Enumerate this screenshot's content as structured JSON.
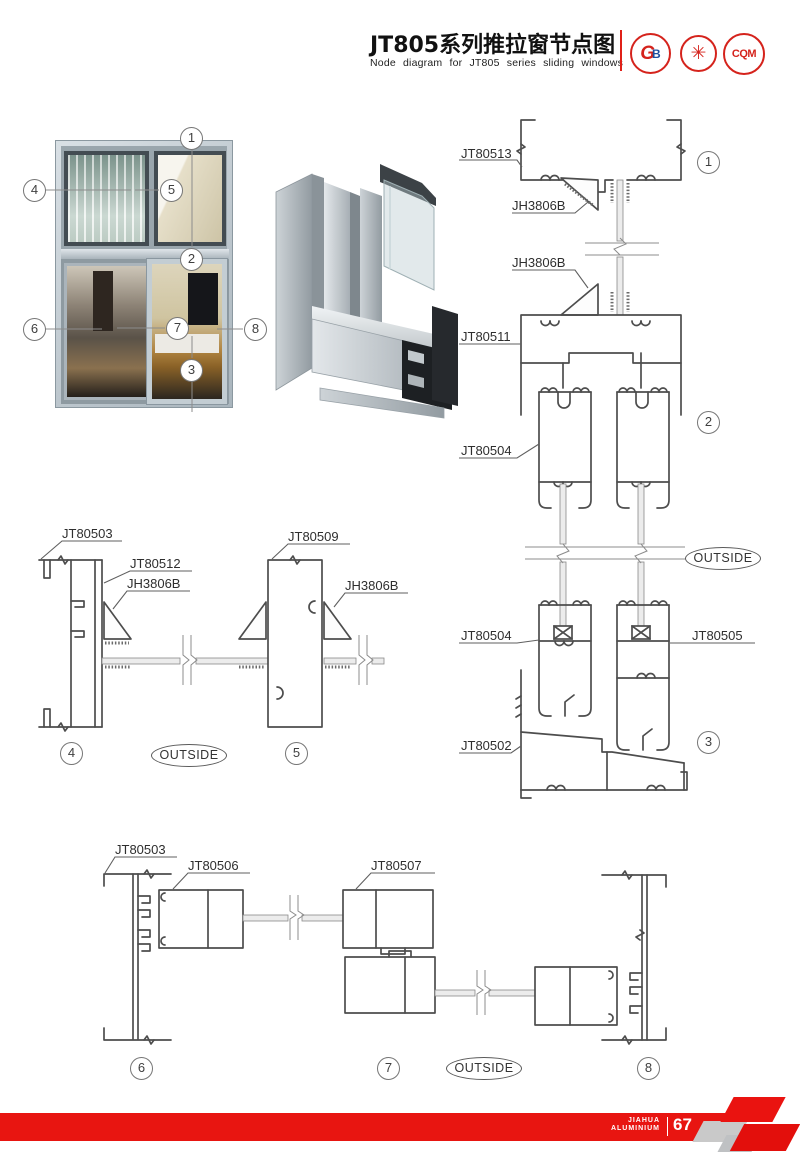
{
  "header": {
    "title_cn": "JT805系列推拉窗节点图",
    "title_en": "Node diagram for JT805 series sliding windows",
    "logos": [
      {
        "name": "gb-cert-badge",
        "letter_g": "G",
        "letter_b": "B"
      },
      {
        "name": "quality-seal-badge",
        "text": "✳"
      },
      {
        "name": "cqm-cert-badge",
        "text": "CQM"
      }
    ]
  },
  "colors": {
    "accent_red": "#e81511",
    "drawing_line": "#4d4d4d"
  },
  "overview": {
    "callouts": [
      "1",
      "2",
      "3",
      "4",
      "5",
      "6",
      "7",
      "8"
    ]
  },
  "right_column": {
    "labels": {
      "jt80513": "JT80513",
      "jh3806b_top": "JH3806B",
      "jh3806b_bottom": "JH3806B",
      "jt80511": "JT80511",
      "jt80504_mid": "JT80504",
      "jt80504_low": "JT80504",
      "jt80505": "JT80505",
      "jt80502": "JT80502"
    },
    "callout_1": "1",
    "callout_2": "2",
    "callout_3": "3",
    "outside": "OUTSIDE"
  },
  "mid_left": {
    "labels": {
      "jt80503": "JT80503",
      "jt80512": "JT80512",
      "jh3806b_left": "JH3806B",
      "jt80509": "JT80509",
      "jh3806b_right": "JH3806B"
    },
    "callout_4": "4",
    "callout_5": "5",
    "outside": "OUTSIDE"
  },
  "bottom_row": {
    "labels": {
      "jt80503": "JT80503",
      "jt80506": "JT80506",
      "jt80507": "JT80507"
    },
    "callout_6": "6",
    "callout_7": "7",
    "callout_8": "8",
    "outside": "OUTSIDE"
  },
  "footer": {
    "brand_line1": "JIAHUA",
    "brand_line2": "ALUMINIUM",
    "page_number": "67"
  }
}
